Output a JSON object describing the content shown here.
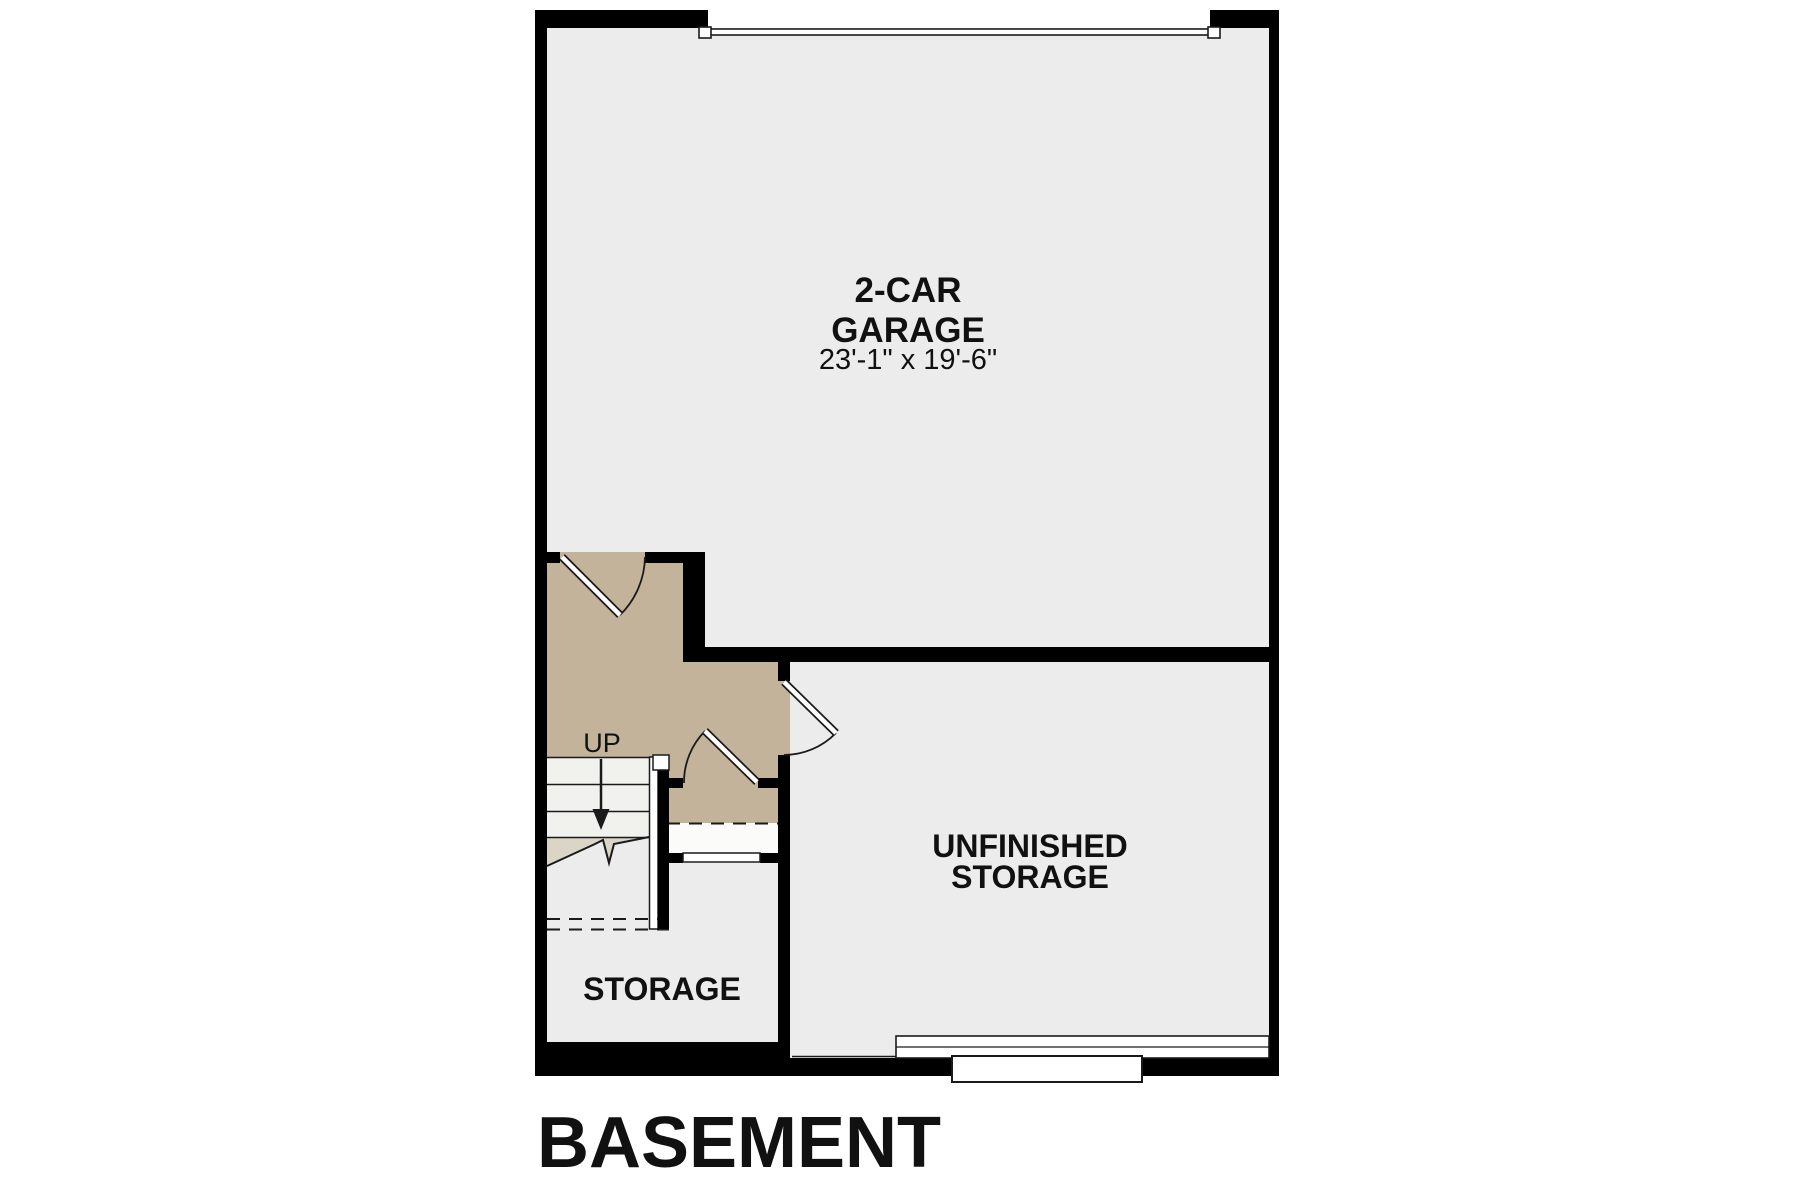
{
  "plan": {
    "title": "BASEMENT"
  },
  "rooms": {
    "garage": {
      "name_line1": "2-CAR",
      "name_line2": "GARAGE",
      "dimensions": "23'-1\" x 19'-6\""
    },
    "unfinished_storage": {
      "name_line1": "UNFINISHED",
      "name_line2": "STORAGE"
    },
    "storage": {
      "name": "STORAGE"
    }
  },
  "stairs": {
    "direction_label": "UP"
  },
  "colors": {
    "wall": "#000000",
    "garage_floor": "#ececec",
    "unfinished_storage_floor": "#ececec",
    "storage_floor": "#ececec",
    "entry_floor_tan": "#c3b39a",
    "stair_tread": "#f1f1ee",
    "under_stair_beige": "#dbd5c7",
    "landing_white": "#fbfbfa",
    "background": "#ffffff",
    "text": "#111111"
  }
}
